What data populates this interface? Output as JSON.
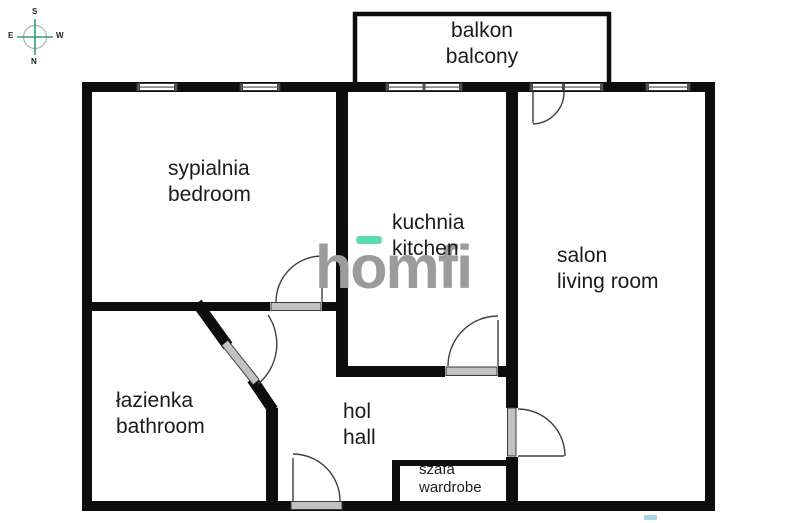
{
  "title": "apartment floor plan",
  "watermark": {
    "text": "homfi"
  },
  "compass": {
    "s": "S",
    "w": "W",
    "n": "N",
    "e": "E"
  },
  "rooms": [
    {
      "id": "balcony",
      "label_pl": "balkon",
      "label_en": "balcony"
    },
    {
      "id": "bedroom",
      "label_pl": "sypialnia",
      "label_en": "bedroom"
    },
    {
      "id": "kitchen",
      "label_pl": "kuchnia",
      "label_en": "kitchen"
    },
    {
      "id": "living-room",
      "label_pl": "salon",
      "label_en": "living room"
    },
    {
      "id": "bathroom",
      "label_pl": "łazienka",
      "label_en": "bathroom"
    },
    {
      "id": "hall",
      "label_pl": "hol",
      "label_en": "hall"
    },
    {
      "id": "wardrobe",
      "label_pl": "szafa",
      "label_en": "wardrobe"
    }
  ],
  "colors": {
    "wall": "#0d0d0d",
    "door_leaf_gray": "#c2c2c2",
    "window_gray": "#8f8f8f",
    "arc_line": "#3f3f3f",
    "logo_gray": "#9b9b9b",
    "accent_teal": "#5ddbad",
    "compass_teal": "#29a17c"
  }
}
